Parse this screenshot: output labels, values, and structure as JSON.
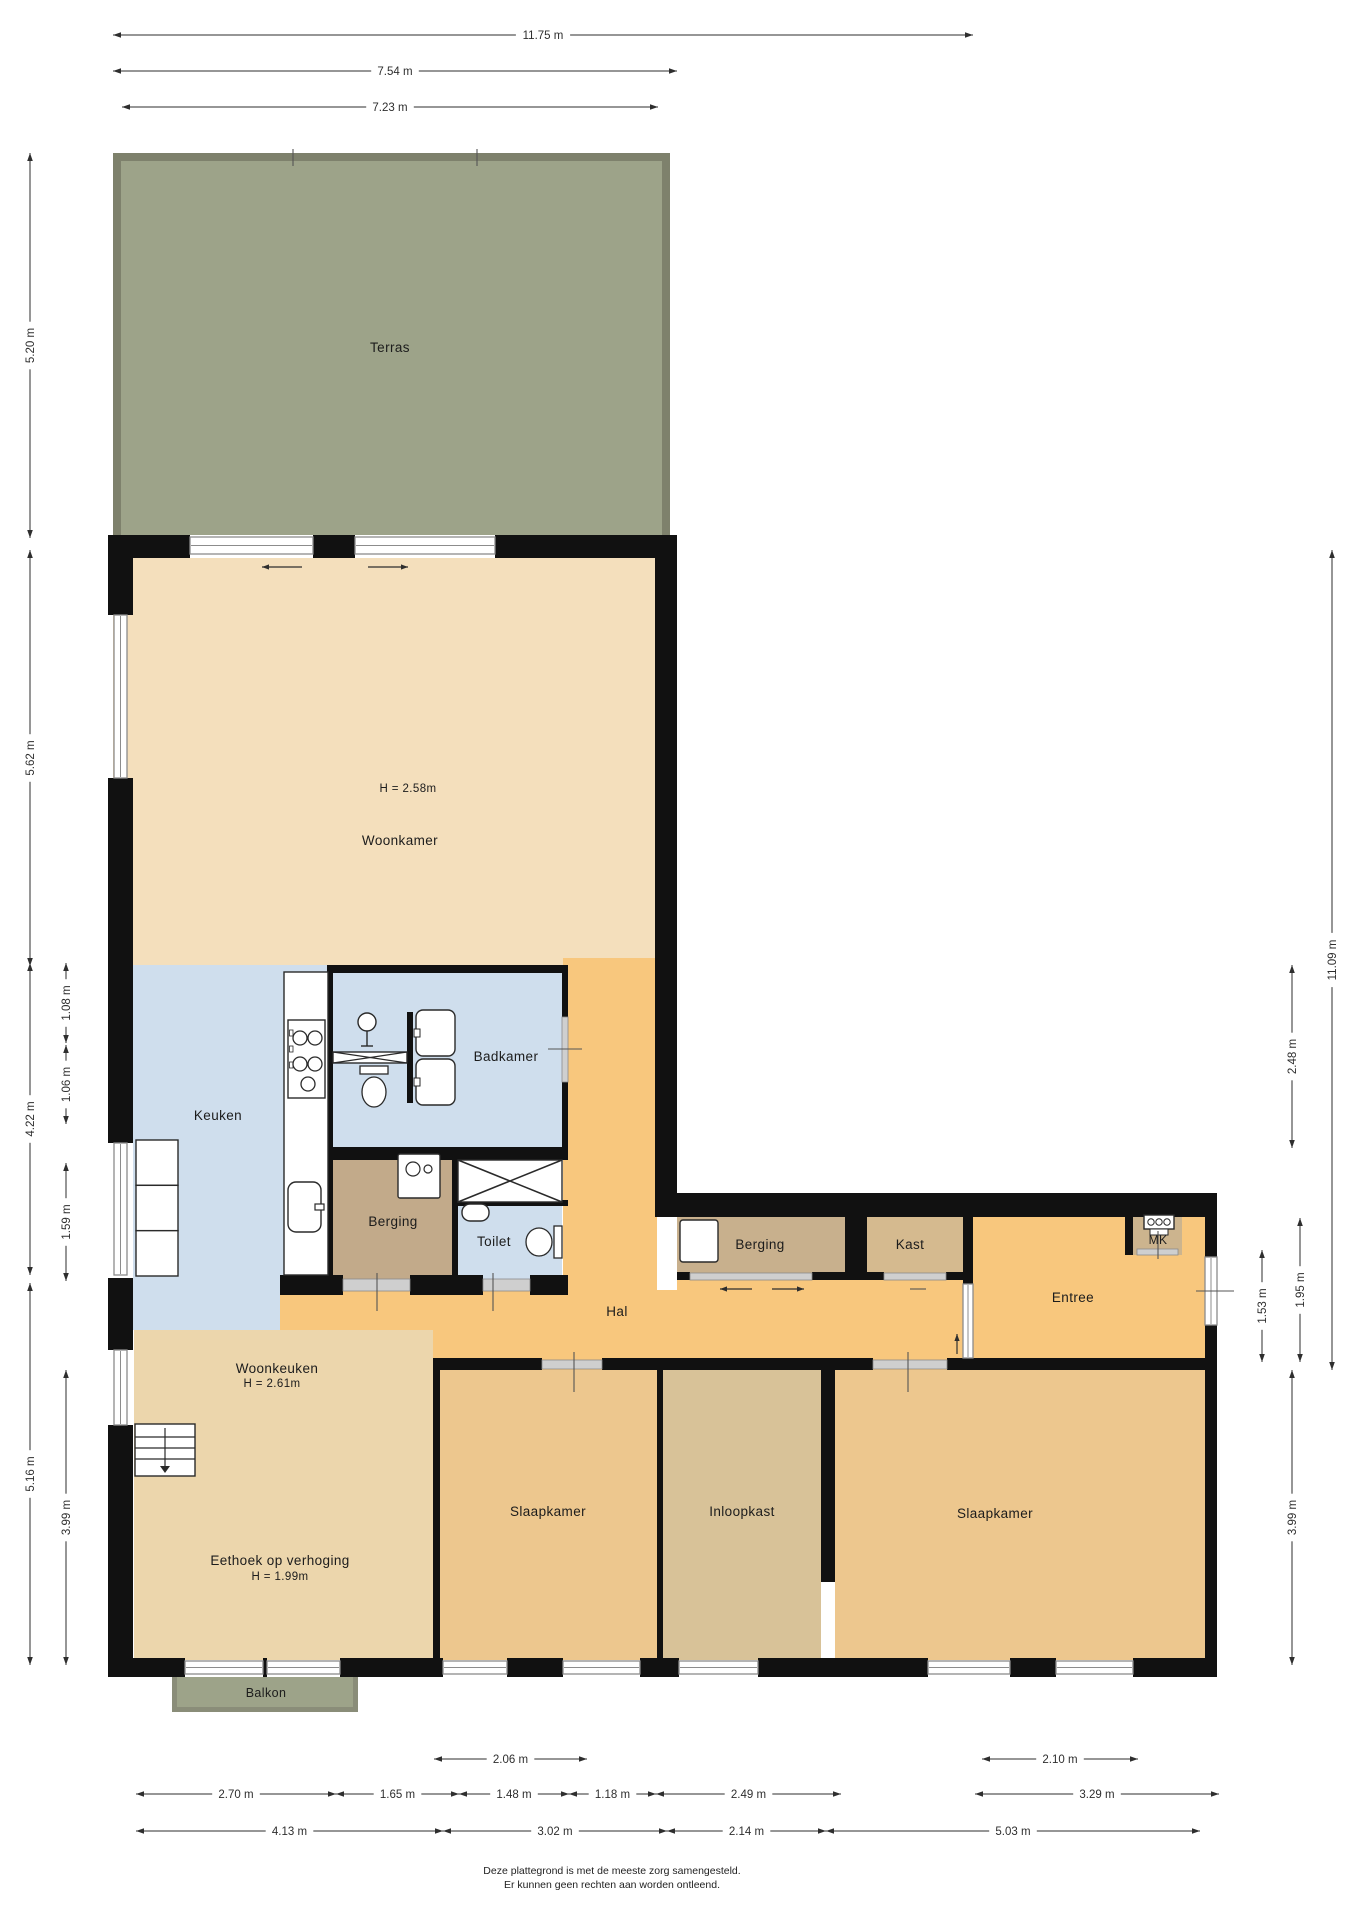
{
  "page": {
    "footer_line1": "Deze plattegrond is met de meeste zorg samengesteld.",
    "footer_line2": "Er kunnen geen rechten aan worden ontleend."
  },
  "colors": {
    "terras": "#9da389",
    "terras_border": "#7e816c",
    "woonkamer": "#f4dfbc",
    "woonkeuken": "#ecd6ac",
    "oranje": "#f8c77d",
    "blauw": "#cfdeed",
    "berging1": "#c2aa8a",
    "berging2": "#c8b08d",
    "kast": "#d5ba8f",
    "mk": "#ccb48e",
    "inloopkast": "#d8c298",
    "slaapkamer": "#edc78e",
    "wall": "#111111",
    "window_frame": "#8c8c8c",
    "door_fill": "#cfcfcf",
    "door_stroke": "#8a8a8a",
    "dim": "#2e2e2e",
    "text": "#1c1c1c",
    "fixture_stroke": "#2a2a2a"
  },
  "floorplan": {
    "canvas": {
      "w": 1358,
      "h": 1920
    },
    "rooms": [
      {
        "id": "terras",
        "x": 113,
        "y": 153,
        "w": 557,
        "h": 382,
        "color": "terras"
      },
      {
        "id": "woonkamer",
        "x": 113,
        "y": 558,
        "w": 544,
        "h": 407,
        "color": "woonkamer"
      },
      {
        "id": "hal-strip",
        "x": 563,
        "y": 958,
        "w": 94,
        "h": 412,
        "color": "oranje"
      },
      {
        "id": "keuken",
        "x": 133,
        "y": 965,
        "w": 200,
        "h": 365,
        "color": "blauw"
      },
      {
        "id": "badkamer",
        "x": 333,
        "y": 965,
        "w": 229,
        "h": 188,
        "color": "blauw"
      },
      {
        "id": "berging-1",
        "x": 333,
        "y": 1153,
        "w": 119,
        "h": 127,
        "color": "berging1"
      },
      {
        "id": "toilet",
        "x": 458,
        "y": 1200,
        "w": 104,
        "h": 80,
        "color": "blauw"
      },
      {
        "id": "hal-west",
        "x": 280,
        "y": 1290,
        "w": 153,
        "h": 45,
        "color": "oranje"
      },
      {
        "id": "hal-main",
        "x": 280,
        "y": 1290,
        "w": 683,
        "h": 80,
        "color": "oranje"
      },
      {
        "id": "hal-east",
        "x": 677,
        "y": 1280,
        "w": 296,
        "h": 90,
        "color": "oranje"
      },
      {
        "id": "entree",
        "x": 973,
        "y": 1217,
        "w": 232,
        "h": 153,
        "color": "oranje"
      },
      {
        "id": "berging-2",
        "x": 677,
        "y": 1217,
        "w": 168,
        "h": 63,
        "color": "berging2"
      },
      {
        "id": "kast",
        "x": 867,
        "y": 1217,
        "w": 96,
        "h": 63,
        "color": "kast"
      },
      {
        "id": "mk",
        "x": 1133,
        "y": 1217,
        "w": 49,
        "h": 38,
        "color": "mk"
      },
      {
        "id": "woonkeuken",
        "x": 134,
        "y": 1330,
        "w": 299,
        "h": 330,
        "color": "woonkeuken"
      },
      {
        "id": "slaapkamer-1",
        "x": 440,
        "y": 1370,
        "w": 217,
        "h": 290,
        "color": "slaapkamer"
      },
      {
        "id": "inloopkast",
        "x": 663,
        "y": 1370,
        "w": 158,
        "h": 290,
        "color": "inloopkast"
      },
      {
        "id": "slaapkamer-2",
        "x": 835,
        "y": 1370,
        "w": 370,
        "h": 290,
        "color": "slaapkamer"
      },
      {
        "id": "balkon",
        "x": 172,
        "y": 1677,
        "w": 186,
        "h": 35,
        "color": "terras"
      }
    ],
    "terras_border": [
      [
        113,
        153,
        557,
        8
      ],
      [
        113,
        153,
        8,
        382
      ],
      [
        662,
        153,
        8,
        382
      ]
    ],
    "balkon_border": [
      [
        172,
        1677,
        5,
        35
      ],
      [
        353,
        1677,
        5,
        35
      ],
      [
        172,
        1707,
        186,
        5
      ]
    ],
    "walls": [
      [
        108,
        535,
        25,
        80
      ],
      [
        108,
        778,
        25,
        365
      ],
      [
        108,
        1278,
        25,
        72
      ],
      [
        108,
        1425,
        25,
        252
      ],
      [
        108,
        535,
        82,
        23
      ],
      [
        313,
        535,
        42,
        23
      ],
      [
        495,
        535,
        182,
        23
      ],
      [
        655,
        535,
        22,
        670
      ],
      [
        655,
        1193,
        562,
        24
      ],
      [
        1205,
        1193,
        12,
        64
      ],
      [
        1205,
        1325,
        12,
        352
      ],
      [
        327,
        965,
        241,
        8
      ],
      [
        327,
        965,
        6,
        315
      ],
      [
        327,
        1147,
        241,
        13
      ],
      [
        452,
        1160,
        6,
        115
      ],
      [
        562,
        965,
        6,
        52
      ],
      [
        562,
        1082,
        6,
        78
      ],
      [
        452,
        1200,
        116,
        6
      ],
      [
        280,
        1275,
        63,
        20
      ],
      [
        410,
        1275,
        73,
        20
      ],
      [
        530,
        1275,
        38,
        20
      ],
      [
        433,
        1358,
        109,
        12
      ],
      [
        602,
        1358,
        271,
        12
      ],
      [
        947,
        1358,
        270,
        12
      ],
      [
        433,
        1358,
        7,
        305
      ],
      [
        657,
        1370,
        6,
        290
      ],
      [
        821,
        1370,
        14,
        212
      ],
      [
        963,
        1217,
        10,
        67
      ],
      [
        845,
        1217,
        22,
        57
      ],
      [
        677,
        1272,
        13,
        8
      ],
      [
        812,
        1272,
        72,
        8
      ],
      [
        946,
        1272,
        27,
        8
      ],
      [
        1125,
        1217,
        8,
        38
      ],
      [
        108,
        1658,
        77,
        19
      ],
      [
        263,
        1658,
        4,
        19
      ],
      [
        340,
        1658,
        103,
        19
      ],
      [
        507,
        1658,
        56,
        19
      ],
      [
        640,
        1658,
        39,
        19
      ],
      [
        758,
        1658,
        170,
        19
      ],
      [
        1010,
        1658,
        46,
        19
      ],
      [
        1133,
        1658,
        84,
        19
      ],
      [
        407,
        1012,
        6,
        91
      ]
    ],
    "windows": [
      {
        "x": 114,
        "y": 615,
        "w": 13,
        "h": 163
      },
      {
        "x": 114,
        "y": 1143,
        "w": 13,
        "h": 132
      },
      {
        "x": 114,
        "y": 1350,
        "w": 13,
        "h": 75
      },
      {
        "x": 190,
        "y": 537,
        "w": 123,
        "h": 17
      },
      {
        "x": 355,
        "y": 537,
        "w": 140,
        "h": 17
      },
      {
        "x": 185,
        "y": 1661,
        "w": 78,
        "h": 13
      },
      {
        "x": 267,
        "y": 1661,
        "w": 73,
        "h": 13
      },
      {
        "x": 443,
        "y": 1661,
        "w": 64,
        "h": 13
      },
      {
        "x": 563,
        "y": 1661,
        "w": 77,
        "h": 13
      },
      {
        "x": 679,
        "y": 1661,
        "w": 79,
        "h": 13
      },
      {
        "x": 928,
        "y": 1661,
        "w": 82,
        "h": 13
      },
      {
        "x": 1056,
        "y": 1661,
        "w": 77,
        "h": 13
      },
      {
        "x": 1205,
        "y": 1257,
        "w": 12,
        "h": 68
      },
      {
        "x": 963,
        "y": 1284,
        "w": 10,
        "h": 74
      }
    ],
    "doors": [
      [
        343,
        1279,
        67,
        12
      ],
      [
        483,
        1279,
        47,
        12
      ],
      [
        562,
        1017,
        6,
        65
      ],
      [
        690,
        1273,
        122,
        7
      ],
      [
        884,
        1273,
        62,
        7
      ],
      [
        542,
        1360,
        60,
        9
      ],
      [
        873,
        1360,
        74,
        9
      ],
      [
        1137,
        1249,
        41,
        6
      ]
    ],
    "arrows": [
      {
        "x1": 302,
        "y1": 567,
        "x2": 262,
        "y2": 567
      },
      {
        "x1": 368,
        "y1": 567,
        "x2": 408,
        "y2": 567
      },
      {
        "x1": 752,
        "y1": 1289,
        "x2": 720,
        "y2": 1289
      },
      {
        "x1": 772,
        "y1": 1289,
        "x2": 804,
        "y2": 1289
      },
      {
        "x1": 957,
        "y1": 1354,
        "x2": 957,
        "y2": 1334
      }
    ],
    "ticks": [
      [
        493,
        1273,
        493,
        1311
      ],
      [
        377,
        1273,
        377,
        1311
      ],
      [
        574,
        1352,
        574,
        1392
      ],
      [
        908,
        1352,
        908,
        1392
      ],
      [
        1196,
        1291,
        1234,
        1291
      ],
      [
        548,
        1049,
        582,
        1049
      ],
      [
        1158,
        1231,
        1158,
        1259
      ],
      [
        293,
        149,
        293,
        166
      ],
      [
        477,
        149,
        477,
        166
      ],
      [
        910,
        1289,
        926,
        1289
      ]
    ],
    "fixtures": [
      {
        "type": "counter",
        "x": 284,
        "y": 972,
        "w": 44,
        "h": 303
      },
      {
        "type": "hob",
        "x": 288,
        "y": 1020,
        "w": 37,
        "h": 78
      },
      {
        "type": "ksink",
        "x": 288,
        "y": 1182,
        "w": 33,
        "h": 50
      },
      {
        "type": "fridge",
        "x": 136,
        "y": 1140,
        "w": 42,
        "h": 136
      },
      {
        "type": "shower_head",
        "x": 367,
        "y": 1022
      },
      {
        "type": "shower_screen",
        "x": 333,
        "y": 1052,
        "w": 74,
        "h": 11
      },
      {
        "type": "wc_front",
        "x": 360,
        "y": 1066,
        "w": 28,
        "h": 42
      },
      {
        "type": "sink_left",
        "x": 416,
        "y": 1010,
        "w": 39,
        "h": 46
      },
      {
        "type": "sink_left",
        "x": 416,
        "y": 1059,
        "w": 39,
        "h": 46
      },
      {
        "type": "xbox",
        "x": 458,
        "y": 1160,
        "w": 104,
        "h": 42
      },
      {
        "type": "boiler",
        "x": 398,
        "y": 1154,
        "w": 42,
        "h": 44
      },
      {
        "type": "basin",
        "x": 462,
        "y": 1204,
        "w": 27,
        "h": 17
      },
      {
        "type": "wc_side",
        "x": 526,
        "y": 1226,
        "w": 36,
        "h": 32
      },
      {
        "type": "washer",
        "x": 680,
        "y": 1220,
        "w": 38,
        "h": 42
      },
      {
        "type": "meter",
        "x": 1144,
        "y": 1215,
        "w": 30,
        "h": 22
      },
      {
        "type": "stairs",
        "x": 135,
        "y": 1424,
        "w": 60,
        "h": 52
      }
    ],
    "dims": [
      {
        "x1": 113,
        "y1": 35,
        "x2": 973,
        "y2": 35,
        "label": "11.75 m"
      },
      {
        "x1": 113,
        "y1": 71,
        "x2": 677,
        "y2": 71,
        "label": "7.54 m"
      },
      {
        "x1": 122,
        "y1": 107,
        "x2": 658,
        "y2": 107,
        "label": "7.23 m"
      },
      {
        "x1": 30,
        "y1": 153,
        "x2": 30,
        "y2": 538,
        "label": "5.20 m"
      },
      {
        "x1": 30,
        "y1": 550,
        "x2": 30,
        "y2": 966,
        "label": "5.62 m"
      },
      {
        "x1": 30,
        "y1": 963,
        "x2": 30,
        "y2": 1275,
        "label": "4.22 m"
      },
      {
        "x1": 30,
        "y1": 1283,
        "x2": 30,
        "y2": 1665,
        "label": "5.16 m"
      },
      {
        "x1": 66,
        "y1": 963,
        "x2": 66,
        "y2": 1043,
        "label": "1.08 m"
      },
      {
        "x1": 66,
        "y1": 1045,
        "x2": 66,
        "y2": 1124,
        "label": "1.06 m"
      },
      {
        "x1": 66,
        "y1": 1163,
        "x2": 66,
        "y2": 1281,
        "label": "1.59 m"
      },
      {
        "x1": 66,
        "y1": 1370,
        "x2": 66,
        "y2": 1665,
        "label": "3.99 m"
      },
      {
        "x1": 1332,
        "y1": 550,
        "x2": 1332,
        "y2": 1370,
        "label": "11.09 m"
      },
      {
        "x1": 1292,
        "y1": 965,
        "x2": 1292,
        "y2": 1148,
        "label": "2.48 m"
      },
      {
        "x1": 1300,
        "y1": 1218,
        "x2": 1300,
        "y2": 1362,
        "label": "1.95 m"
      },
      {
        "x1": 1262,
        "y1": 1250,
        "x2": 1262,
        "y2": 1362,
        "label": "1.53 m"
      },
      {
        "x1": 1292,
        "y1": 1370,
        "x2": 1292,
        "y2": 1665,
        "label": "3.99 m"
      },
      {
        "x1": 434,
        "y1": 1759,
        "x2": 587,
        "y2": 1759,
        "label": "2.06 m"
      },
      {
        "x1": 982,
        "y1": 1759,
        "x2": 1138,
        "y2": 1759,
        "label": "2.10 m"
      },
      {
        "x1": 136,
        "y1": 1794,
        "x2": 336,
        "y2": 1794,
        "label": "2.70 m"
      },
      {
        "x1": 336,
        "y1": 1794,
        "x2": 459,
        "y2": 1794,
        "label": "1.65 m"
      },
      {
        "x1": 459,
        "y1": 1794,
        "x2": 569,
        "y2": 1794,
        "label": "1.48 m"
      },
      {
        "x1": 569,
        "y1": 1794,
        "x2": 656,
        "y2": 1794,
        "label": "1.18 m"
      },
      {
        "x1": 656,
        "y1": 1794,
        "x2": 841,
        "y2": 1794,
        "label": "2.49 m"
      },
      {
        "x1": 975,
        "y1": 1794,
        "x2": 1219,
        "y2": 1794,
        "label": "3.29 m"
      },
      {
        "x1": 136,
        "y1": 1831,
        "x2": 443,
        "y2": 1831,
        "label": "4.13 m"
      },
      {
        "x1": 443,
        "y1": 1831,
        "x2": 667,
        "y2": 1831,
        "label": "3.02 m"
      },
      {
        "x1": 667,
        "y1": 1831,
        "x2": 826,
        "y2": 1831,
        "label": "2.14 m"
      },
      {
        "x1": 826,
        "y1": 1831,
        "x2": 1200,
        "y2": 1831,
        "label": "5.03 m"
      }
    ],
    "texts": [
      {
        "name": "terras-label",
        "t": "Terras",
        "x": 390,
        "y": 352,
        "s": 13.5
      },
      {
        "name": "woonkamer-height-label",
        "t": "H = 2.58m",
        "x": 408,
        "y": 792,
        "s": 11.5
      },
      {
        "name": "woonkamer-label",
        "t": "Woonkamer",
        "x": 400,
        "y": 845,
        "s": 13.5
      },
      {
        "name": "keuken-label",
        "t": "Keuken",
        "x": 218,
        "y": 1120,
        "s": 13.5
      },
      {
        "name": "badkamer-label",
        "t": "Badkamer",
        "x": 506,
        "y": 1061,
        "s": 13.5
      },
      {
        "name": "berging-1-label",
        "t": "Berging",
        "x": 393,
        "y": 1226,
        "s": 13.5
      },
      {
        "name": "toilet-label",
        "t": "Toilet",
        "x": 494,
        "y": 1246,
        "s": 13.5
      },
      {
        "name": "hal-label",
        "t": "Hal",
        "x": 617,
        "y": 1316,
        "s": 13.5
      },
      {
        "name": "berging-2-label",
        "t": "Berging",
        "x": 760,
        "y": 1249,
        "s": 13.5
      },
      {
        "name": "kast-label",
        "t": "Kast",
        "x": 910,
        "y": 1249,
        "s": 13.5
      },
      {
        "name": "entree-label",
        "t": "Entree",
        "x": 1073,
        "y": 1302,
        "s": 13.5
      },
      {
        "name": "mk-label",
        "t": "MK",
        "x": 1158,
        "y": 1244,
        "s": 12
      },
      {
        "name": "woonkeuken-label",
        "t": "Woonkeuken",
        "x": 277,
        "y": 1373,
        "s": 13.5
      },
      {
        "name": "woonkeuken-height-label",
        "t": "H = 2.61m",
        "x": 272,
        "y": 1387,
        "s": 11.5
      },
      {
        "name": "eethoek-label",
        "t": "Eethoek op verhoging",
        "x": 280,
        "y": 1565,
        "s": 13.5
      },
      {
        "name": "eethoek-height-label",
        "t": "H = 1.99m",
        "x": 280,
        "y": 1580,
        "s": 11.5
      },
      {
        "name": "balkon-label",
        "t": "Balkon",
        "x": 266,
        "y": 1697,
        "s": 12.5
      },
      {
        "name": "slaapkamer-1-label",
        "t": "Slaapkamer",
        "x": 548,
        "y": 1516,
        "s": 13.5
      },
      {
        "name": "inloopkast-label",
        "t": "Inloopkast",
        "x": 742,
        "y": 1516,
        "s": 13.5
      },
      {
        "name": "slaapkamer-2-label",
        "t": "Slaapkamer",
        "x": 995,
        "y": 1518,
        "s": 13.5
      }
    ]
  }
}
